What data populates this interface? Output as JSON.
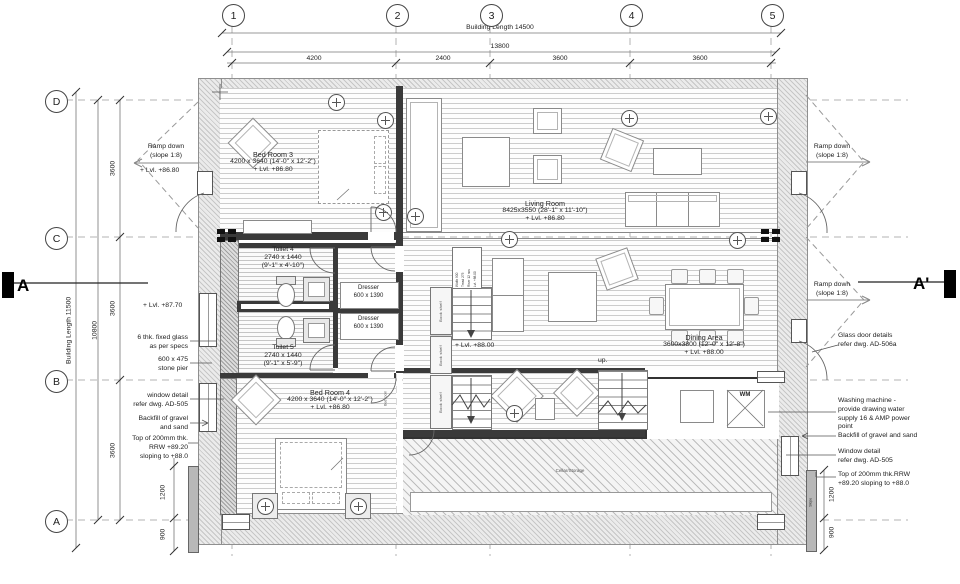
{
  "grid": {
    "cols": [
      "1",
      "2",
      "3",
      "4",
      "5"
    ],
    "rows": [
      "D",
      "C",
      "B",
      "A"
    ]
  },
  "dims": {
    "top": {
      "overall": "Building Length 14500",
      "total": "13800",
      "segments": [
        "4200",
        "2400",
        "3600",
        "3600"
      ]
    },
    "left": {
      "overall": "Building Length 11500",
      "total": "10800",
      "segments": [
        "3600",
        "3600",
        "3600"
      ],
      "stub1": "1200",
      "stub2": "900"
    },
    "right": {
      "stub1": "1200",
      "stub2": "900",
      "slope": "Slope"
    }
  },
  "sections": {
    "left": "A",
    "right": "A'"
  },
  "notes_left": {
    "ramp": "Ramp down\n(slope 1:8)",
    "lvl_top": "Lvl. +86.80",
    "lvl_mid": "Lvl. +87.70",
    "glass": "6 thk. fixed glass\nas per specs",
    "pier": "600 x 475\nstone pier",
    "window": "window detail\nrefer dwg. AD-505",
    "backfill": "Backfill of gravel\nand sand",
    "rrw": "Top of 200mm thk.\nRRW +89.20\nsloping to +88.0"
  },
  "notes_right": {
    "ramp_top": "Ramp down\n(slope 1:8)",
    "ramp_mid": "Ramp down\n(slope 1:8)",
    "glass_door": "Glass door details\nrefer dwg. AD-506a",
    "washing": "Washing machine -\nprovide drawing water\nsupply 16 & AMP power\npoint",
    "backfill": "Backfill of gravel and sand",
    "window": "Window detail\nrefer dwg. AD-505",
    "rrw": "Top of 200mm thk.RRW\n+89.20 sloping to +88.0"
  },
  "rooms": {
    "bed3": {
      "name": "Bed Room 3",
      "size": "4200 x 3640 (14'-0\" x 12'-2\")",
      "level": "Lvl. +86.80"
    },
    "living": {
      "name": "Living Room",
      "size": "8425x3550 (28'-1\" x 11'-10\")",
      "level": "Lvl. +86.80"
    },
    "toilet4": {
      "name": "Toilet 4",
      "size": "2740 x 1440",
      "size_ft": "(9'-1\" x 4'-10\")"
    },
    "toilet5": {
      "name": "Toilet 5",
      "size": "2740 x 1440",
      "size_ft": "(9'-1\" x 5'-9\")"
    },
    "dresser": {
      "name": "Dresser",
      "size": "600 x 1390"
    },
    "dining": {
      "name": "Dining Area",
      "size": "3600x3800 (12'-0\" x 12'-8\")",
      "level": "Lvl. +88.00"
    },
    "bed4": {
      "name": "Bed Room 4",
      "size": "4200 x 3640 (14'-0\" x 12'-2\")",
      "level": "Lvl. +86.80"
    },
    "family_level": "Lvl. +88.00",
    "cellar": "Cellar/Storage",
    "wm": "WM",
    "up": "up.",
    "bookshelf": "Book shelf",
    "bed_tag": "Bed room",
    "stair_spec": "Width 900\nTread 275\nRiser 12 nos\nLvl. +88.00"
  }
}
